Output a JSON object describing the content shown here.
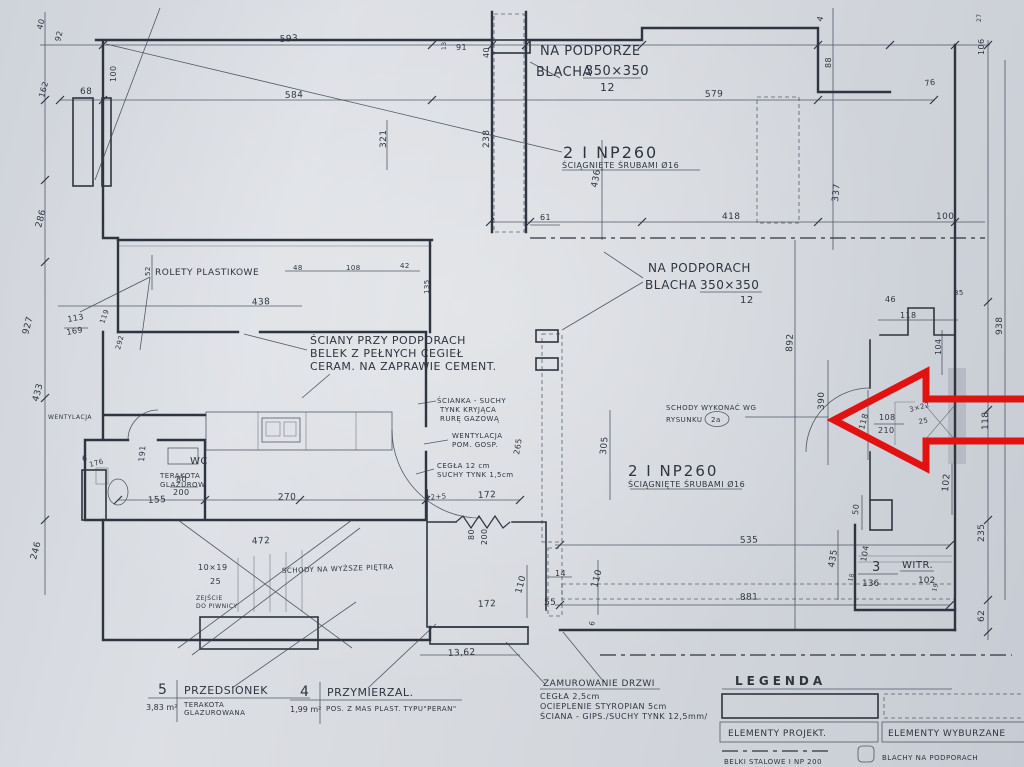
{
  "drawing": {
    "notes": {
      "na_podporze": {
        "l1": "NA PODPORZE",
        "l2": "BLACHA",
        "l2b": "350×350",
        "l3": "12"
      },
      "beam_top": {
        "l1": "2 I NP260",
        "l2": "ŚCIĄGNIĘTE ŚRUBAMI Ø16"
      },
      "na_podporach": {
        "l1": "NA PODPORACH",
        "l2": "BLACHA",
        "l2b": "350×350",
        "l3": "12"
      },
      "sciany_przy": {
        "l1": "ŚCIANY PRZY PODPORACH",
        "l2": "BELEK Z PEŁNYCH CEGIEŁ",
        "l3": "CERAM. NA ZAPRAWIE CEMENT."
      },
      "rolety": {
        "l1": "ROLETY PLASTIKOWE"
      },
      "scianka": {
        "l1": "ŚCIANKA - SUCHY",
        "l2": "TYNK KRYJĄCA",
        "l3": "RURĘ GAZOWĄ"
      },
      "wentylacja_pom": {
        "l1": "WENTYLACJA",
        "l2": "POM. GOSP."
      },
      "cegla": {
        "l1": "CEGŁA 12 cm",
        "l2": "SUCHY TYNK 1,5cm"
      },
      "schody_wykonac": {
        "l1": "SCHODY WYKONAĆ WG",
        "l2": "RYSUNKU",
        "l2b": "2a"
      },
      "beam_mid": {
        "l1": "2 I NP260",
        "l2": "ŚCIĄGNIĘTE ŚRUBAMI Ø16"
      },
      "wc": {
        "l1": "WC",
        "l2": "TERAKOTA",
        "l3": "GLAZUROW."
      },
      "wentylacja_left": {
        "l1": "WENTYLACJA"
      },
      "schody_pietra": {
        "l1": "SCHODY NA WYŻSZE PIĘTRA"
      },
      "stopnie": {
        "l1": "10×19",
        "l2": "25"
      },
      "zejscie": {
        "l1": "ZEJŚCIE",
        "l2": "DO PIWNICY"
      },
      "witryna": {
        "num": "3",
        "area": "136",
        "name": "WITR.",
        "dim": "102"
      },
      "zamurowanie": {
        "l1": "ZAMUROWANIE DRZWI",
        "l2": "CEGŁA 2,5cm",
        "l3": "OCIEPLENIE STYROPIAN 5cm",
        "l4": "ŚCIANA - GIPS./SUCHY TYNK 12,5mm/"
      }
    },
    "rooms": {
      "przedsionek": {
        "num": "5",
        "name": "PRZEDSIONEK",
        "area": "3,83 m²",
        "finish1": "TERAKOTA",
        "finish2": "GLAZUROWANA"
      },
      "przymierzalnia": {
        "num": "4",
        "name": "PRZYMIERZAL.",
        "area": "1,99 m²",
        "finish1": "POS. Z MAS PLAST. TYPU\"PERAN\""
      }
    },
    "legend": {
      "title": "LEGENDA",
      "projected": "ELEMENTY PROJEKT.",
      "demolished": "ELEMENTY WYBURZANE",
      "steel_beams": "BELKI STALOWE I NP 200",
      "support_plates": "BLACHY NA PODPORACH"
    },
    "colors": {
      "ink": "#2e3440",
      "paper": "#d7dade",
      "arrow": "#e01212"
    },
    "dimensions": [
      {
        "t": "593",
        "x": 280,
        "y": 42,
        "r": -4
      },
      {
        "t": "584",
        "x": 285,
        "y": 98,
        "r": -2
      },
      {
        "t": "91",
        "x": 456,
        "y": 50,
        "r": 0,
        "s": 8
      },
      {
        "t": "13",
        "x": 446,
        "y": 50,
        "r": -90,
        "s": 6
      },
      {
        "t": "40",
        "x": 489,
        "y": 58,
        "r": -90,
        "s": 8
      },
      {
        "t": "579",
        "x": 705,
        "y": 97,
        "r": -2
      },
      {
        "t": "76",
        "x": 925,
        "y": 86,
        "r": -8,
        "s": 8
      },
      {
        "t": "68",
        "x": 80,
        "y": 94,
        "r": 0,
        "s": 9
      },
      {
        "t": "40",
        "x": 42,
        "y": 30,
        "r": -75,
        "s": 8
      },
      {
        "t": "92",
        "x": 60,
        "y": 42,
        "r": -75,
        "s": 8
      },
      {
        "t": "162",
        "x": 44,
        "y": 98,
        "r": -75,
        "s": 8
      },
      {
        "t": "100",
        "x": 116,
        "y": 82,
        "r": -90,
        "s": 8
      },
      {
        "t": "4",
        "x": 822,
        "y": 22,
        "r": -75,
        "s": 8
      },
      {
        "t": "88",
        "x": 831,
        "y": 68,
        "r": -90,
        "s": 8
      },
      {
        "t": "27",
        "x": 981,
        "y": 22,
        "r": -90,
        "s": 6
      },
      {
        "t": "106",
        "x": 984,
        "y": 55,
        "r": -90,
        "s": 8
      },
      {
        "t": "286",
        "x": 41,
        "y": 228,
        "r": -75,
        "s": 9
      },
      {
        "t": "927",
        "x": 28,
        "y": 335,
        "r": -75,
        "s": 9
      },
      {
        "t": "433",
        "x": 38,
        "y": 402,
        "r": -75,
        "s": 9
      },
      {
        "t": "246",
        "x": 36,
        "y": 560,
        "r": -75,
        "s": 9
      },
      {
        "t": "321",
        "x": 386,
        "y": 148,
        "r": -90,
        "s": 9
      },
      {
        "t": "238",
        "x": 489,
        "y": 148,
        "r": -90,
        "s": 9
      },
      {
        "t": "436",
        "x": 597,
        "y": 188,
        "r": -80,
        "s": 9
      },
      {
        "t": "337",
        "x": 838,
        "y": 202,
        "r": -85,
        "s": 9
      },
      {
        "t": "61",
        "x": 540,
        "y": 220,
        "r": 0,
        "s": 8
      },
      {
        "t": "418",
        "x": 722,
        "y": 219,
        "r": 0,
        "s": 9
      },
      {
        "t": "100",
        "x": 936,
        "y": 219,
        "r": 0,
        "s": 9
      },
      {
        "t": "48",
        "x": 293,
        "y": 270,
        "r": 0,
        "s": 7
      },
      {
        "t": "108",
        "x": 346,
        "y": 270,
        "r": 0,
        "s": 7
      },
      {
        "t": "42",
        "x": 400,
        "y": 268,
        "r": 0,
        "s": 7
      },
      {
        "t": "135",
        "x": 429,
        "y": 294,
        "r": -90,
        "s": 7
      },
      {
        "t": "52",
        "x": 150,
        "y": 276,
        "r": -90,
        "s": 7
      },
      {
        "t": "119",
        "x": 104,
        "y": 324,
        "r": -70,
        "s": 7
      },
      {
        "t": "292",
        "x": 120,
        "y": 350,
        "r": -75,
        "s": 7
      },
      {
        "t": "438",
        "x": 252,
        "y": 305,
        "r": -3,
        "s": 9
      },
      {
        "t": "113",
        "x": 68,
        "y": 322,
        "r": -10,
        "s": 8
      },
      {
        "t": "169",
        "x": 67,
        "y": 335,
        "r": -10,
        "s": 8
      },
      {
        "t": "46",
        "x": 885,
        "y": 302,
        "r": 0,
        "s": 8
      },
      {
        "t": "35",
        "x": 954,
        "y": 295,
        "r": 0,
        "s": 7
      },
      {
        "t": "118",
        "x": 900,
        "y": 318,
        "r": 0,
        "s": 8
      },
      {
        "t": "104",
        "x": 941,
        "y": 355,
        "r": -90,
        "s": 8
      },
      {
        "t": "938",
        "x": 1002,
        "y": 335,
        "r": -90,
        "s": 9
      },
      {
        "t": "892",
        "x": 792,
        "y": 352,
        "r": -87,
        "s": 9
      },
      {
        "t": "390",
        "x": 824,
        "y": 410,
        "r": -90,
        "s": 9
      },
      {
        "t": "108",
        "x": 879,
        "y": 420,
        "r": 0,
        "s": 8
      },
      {
        "t": "210",
        "x": 878,
        "y": 433,
        "r": 0,
        "s": 8
      },
      {
        "t": "118",
        "x": 864,
        "y": 430,
        "r": -75,
        "s": 8
      },
      {
        "t": "3×22",
        "x": 910,
        "y": 412,
        "r": -15,
        "s": 7
      },
      {
        "t": "25",
        "x": 919,
        "y": 424,
        "r": -10,
        "s": 7
      },
      {
        "t": "118",
        "x": 988,
        "y": 430,
        "r": -90,
        "s": 9
      },
      {
        "t": "305",
        "x": 606,
        "y": 455,
        "r": -85,
        "s": 9
      },
      {
        "t": "265",
        "x": 519,
        "y": 455,
        "r": -80,
        "s": 8
      },
      {
        "t": "191",
        "x": 144,
        "y": 462,
        "r": -85,
        "s": 8
      },
      {
        "t": "176",
        "x": 90,
        "y": 467,
        "r": -15,
        "s": 7
      },
      {
        "t": "6",
        "x": 82,
        "y": 461,
        "r": 0,
        "s": 8
      },
      {
        "t": "80",
        "x": 176,
        "y": 482,
        "r": 0,
        "s": 8
      },
      {
        "t": "200",
        "x": 173,
        "y": 495,
        "r": 0,
        "s": 8
      },
      {
        "t": "155",
        "x": 148,
        "y": 503,
        "r": -3,
        "s": 9
      },
      {
        "t": "270",
        "x": 278,
        "y": 500,
        "r": -2,
        "s": 9
      },
      {
        "t": "472",
        "x": 252,
        "y": 544,
        "r": -3,
        "s": 9
      },
      {
        "t": "12+5",
        "x": 426,
        "y": 500,
        "r": -5,
        "s": 7
      },
      {
        "t": "172",
        "x": 478,
        "y": 498,
        "r": -3,
        "s": 9
      },
      {
        "t": "80",
        "x": 474,
        "y": 540,
        "r": -90,
        "s": 8
      },
      {
        "t": "200",
        "x": 487,
        "y": 545,
        "r": -90,
        "s": 8
      },
      {
        "t": "110",
        "x": 521,
        "y": 594,
        "r": -75,
        "s": 9
      },
      {
        "t": "55",
        "x": 544,
        "y": 605,
        "r": 0,
        "s": 9
      },
      {
        "t": "14",
        "x": 555,
        "y": 576,
        "r": 0,
        "s": 8
      },
      {
        "t": "110",
        "x": 597,
        "y": 588,
        "r": -75,
        "s": 9
      },
      {
        "t": "172",
        "x": 478,
        "y": 607,
        "r": -3,
        "s": 9
      },
      {
        "t": "535",
        "x": 740,
        "y": 543,
        "r": -2,
        "s": 9
      },
      {
        "t": "881",
        "x": 740,
        "y": 600,
        "r": -2,
        "s": 9
      },
      {
        "t": "435",
        "x": 834,
        "y": 568,
        "r": -80,
        "s": 9
      },
      {
        "t": "50",
        "x": 858,
        "y": 515,
        "r": -85,
        "s": 8
      },
      {
        "t": "102",
        "x": 948,
        "y": 492,
        "r": -85,
        "s": 9
      },
      {
        "t": "104",
        "x": 866,
        "y": 562,
        "r": -80,
        "s": 8
      },
      {
        "t": "235",
        "x": 984,
        "y": 542,
        "r": -90,
        "s": 9
      },
      {
        "t": "62",
        "x": 984,
        "y": 622,
        "r": -90,
        "s": 9
      },
      {
        "t": "6",
        "x": 594,
        "y": 626,
        "r": -80,
        "s": 7
      },
      {
        "t": "13,62",
        "x": 448,
        "y": 656,
        "r": -3,
        "s": 9
      },
      {
        "t": "19",
        "x": 936,
        "y": 592,
        "r": -75,
        "s": 6
      },
      {
        "t": "18",
        "x": 852,
        "y": 582,
        "r": -75,
        "s": 6
      }
    ]
  }
}
